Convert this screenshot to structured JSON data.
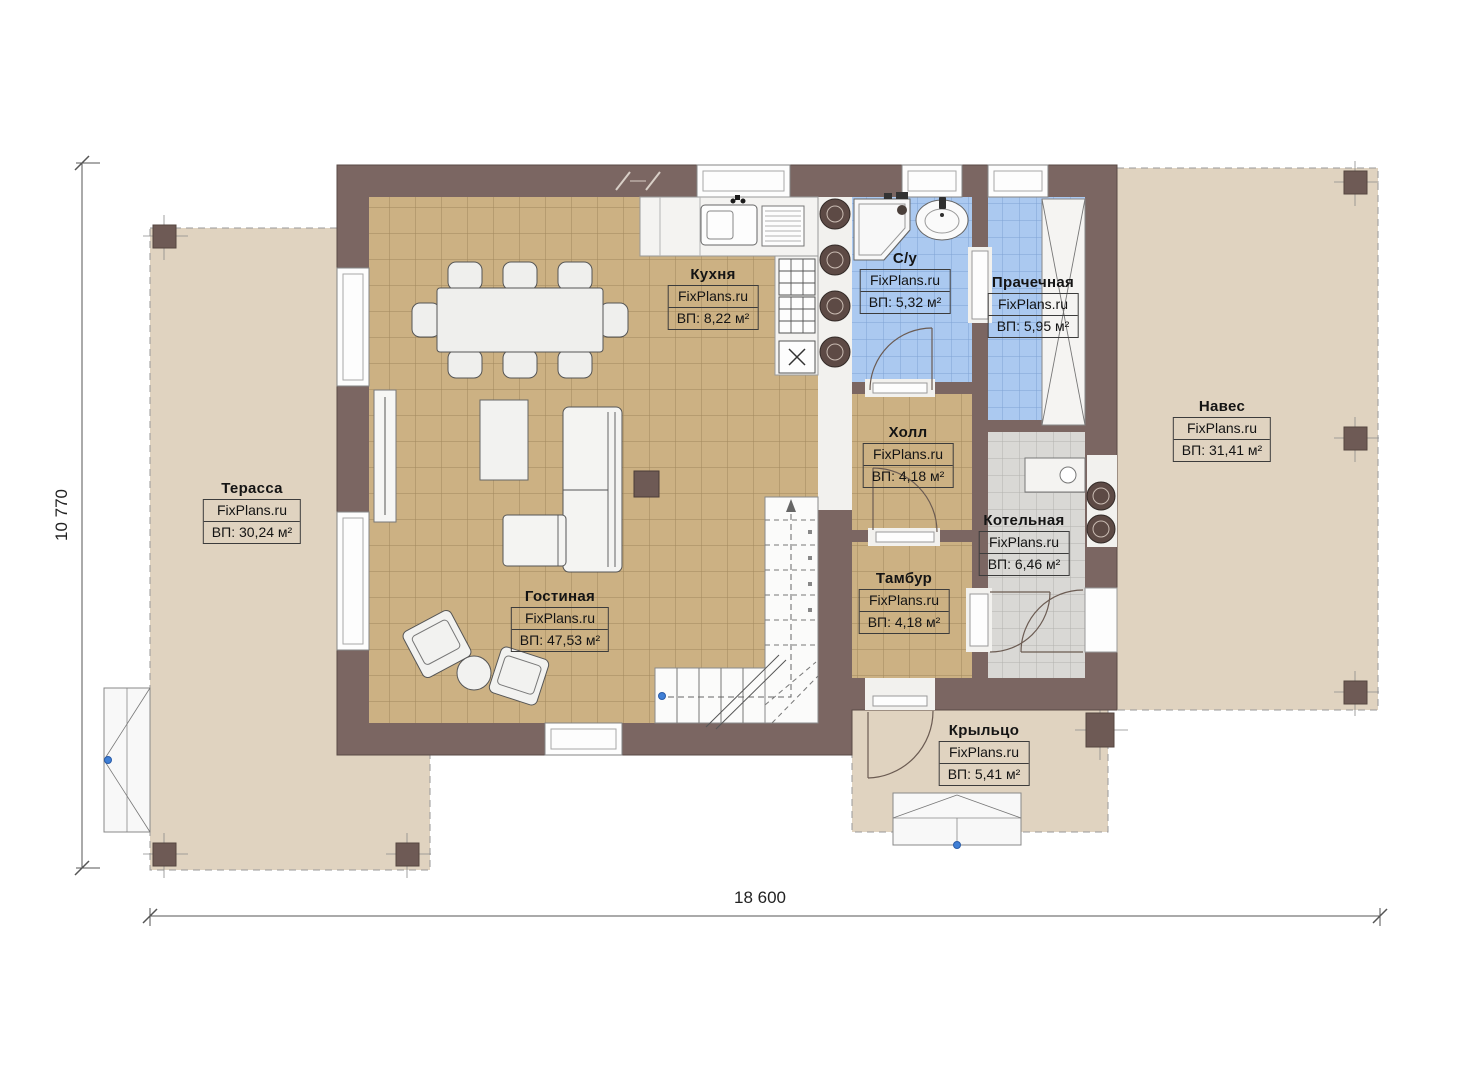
{
  "watermark": "FixPlans.ru",
  "dimensions": {
    "width_label": "18 600",
    "height_label": "10 770"
  },
  "rooms": [
    {
      "name": "Терасса",
      "area": "ВП: 30,24 м²"
    },
    {
      "name": "Кухня",
      "area": "ВП: 8,22 м²"
    },
    {
      "name": "С/у",
      "area": "ВП: 5,32 м²"
    },
    {
      "name": "Прачечная",
      "area": "ВП: 5,95 м²"
    },
    {
      "name": "Навес",
      "area": "ВП: 31,41 м²"
    },
    {
      "name": "Холл",
      "area": "ВП: 4,18 м²"
    },
    {
      "name": "Котельная",
      "area": "ВП: 6,46 м²"
    },
    {
      "name": "Тамбур",
      "area": "ВП: 4,18 м²"
    },
    {
      "name": "Гостиная",
      "area": "ВП: 47,53 м²"
    },
    {
      "name": "Крыльцо",
      "area": "ВП: 5,41 м²"
    }
  ],
  "colors": {
    "wall": "#7b6662",
    "floor_tile": "#ccb183",
    "floor_grid": "#a1875c",
    "wet_tile": "#abc9f0",
    "wet_grid": "#7fa3d4",
    "tech_tile": "#d9d8d5",
    "tech_grid": "#b3b2af",
    "outdoor": "#e0d3c0",
    "post": "#6e5a55",
    "fixture_white": "#f2f1ee",
    "accent_dot": "#3f7fd6"
  }
}
